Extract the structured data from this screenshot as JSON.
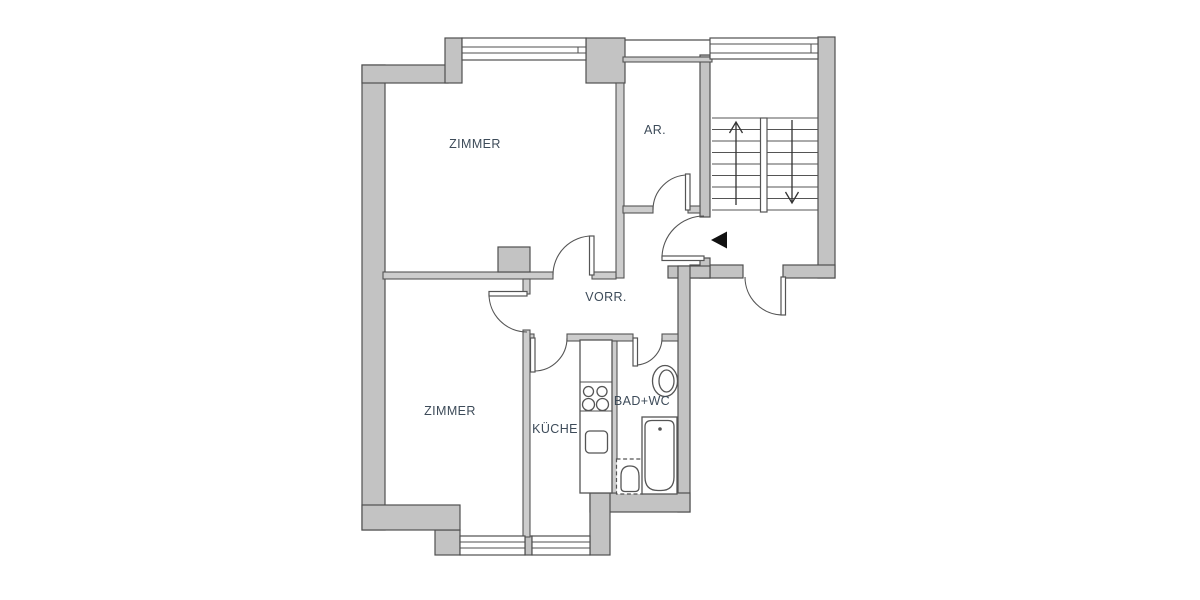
{
  "floor_plan": {
    "type": "apartment-floor-plan",
    "rooms": [
      {
        "id": "zimmer-top",
        "label": "ZIMMER"
      },
      {
        "id": "abstellraum",
        "label": "AR."
      },
      {
        "id": "vorraum",
        "label": "VORR."
      },
      {
        "id": "zimmer-bottom",
        "label": "ZIMMER"
      },
      {
        "id": "kueche",
        "label": "KÜCHE"
      },
      {
        "id": "bad-wc",
        "label": "BAD+WC"
      }
    ],
    "stairs": {
      "up_arrow": "up",
      "down_arrow": "down"
    },
    "icons": [
      "window-icon",
      "door-swing-icon",
      "entrance-arrow-icon",
      "stairs-up-arrow-icon",
      "stairs-down-arrow-icon",
      "stove-icon",
      "kitchen-sink-icon",
      "washbasin-icon",
      "toilet-icon",
      "bathtub-icon",
      "chimney-pier"
    ],
    "colors": {
      "background": "#ffffff",
      "wall_fill": "#c3c3c3",
      "wall_line": "#4f4f4f",
      "label": "#3d4b59",
      "entrance_marker": "#111111"
    }
  }
}
